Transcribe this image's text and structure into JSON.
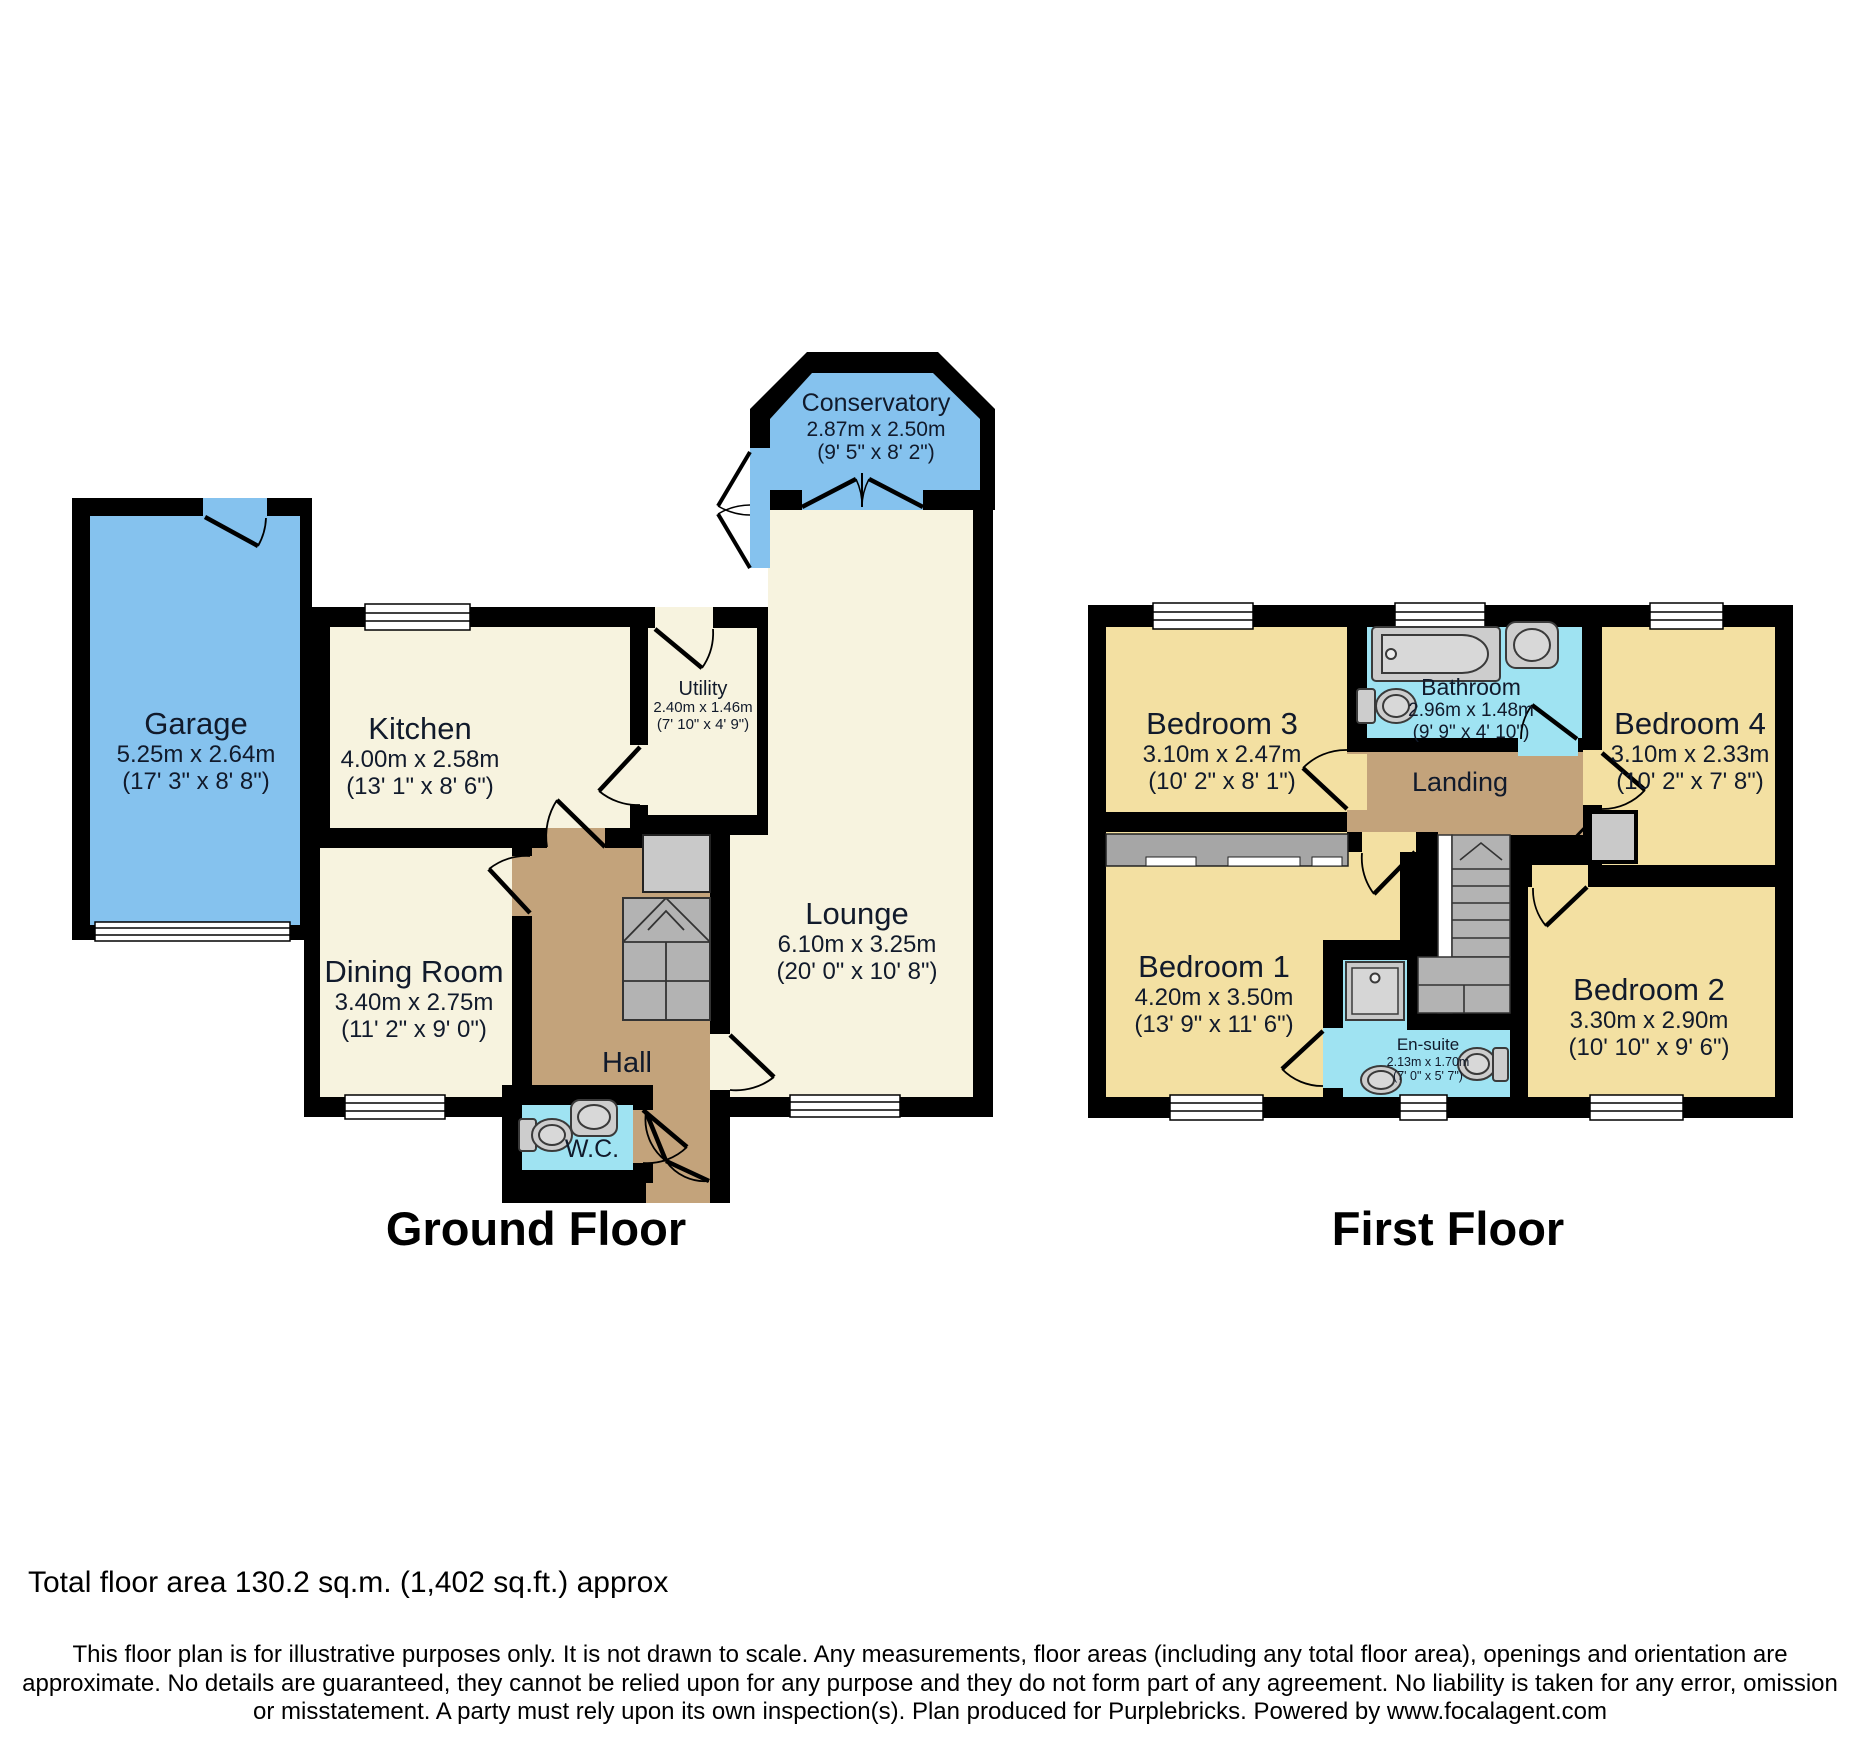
{
  "colors": {
    "wall": "#000000",
    "garage_blue": "#85C2EE",
    "room_cream": "#F7F3DF",
    "bedroom_yellow": "#F3E0A2",
    "wet_cyan": "#9FE3F2",
    "hall_tan": "#C3A37B",
    "stair_gray": "#B3B3B3",
    "cupboard_gray": "#C9C9C9",
    "wardrobe_gray": "#A6A6A6",
    "fixture_gray": "#CDCDCD",
    "fixture_inner_gray": "#D8D8D8",
    "window_white": "#FFFFFF"
  },
  "icons": {
    "bath": "bath-icon",
    "toilet": "toilet-icon",
    "sink": "sink-icon",
    "shower": "shower-icon",
    "stairs": "stairs-icon",
    "window": "window-icon",
    "door": "door-swing-icon",
    "wardrobe": "wardrobe-icon"
  },
  "floors": [
    {
      "label": "Ground Floor",
      "rooms": [
        {
          "name": "Garage",
          "dims_m": "5.25m x 2.64m",
          "dims_ft": "(17' 3\" x 8' 8\")"
        },
        {
          "name": "Kitchen",
          "dims_m": "4.00m x 2.58m",
          "dims_ft": "(13' 1\" x 8' 6\")"
        },
        {
          "name": "Utility",
          "dims_m": "2.40m x 1.46m",
          "dims_ft": "(7' 10\" x 4' 9\")"
        },
        {
          "name": "Conservatory",
          "dims_m": "2.87m x 2.50m",
          "dims_ft": "(9' 5\" x 8' 2\")"
        },
        {
          "name": "Dining Room",
          "dims_m": "3.40m x 2.75m",
          "dims_ft": "(11' 2\" x 9' 0\")"
        },
        {
          "name": "Lounge",
          "dims_m": "6.10m x 3.25m",
          "dims_ft": "(20' 0\" x 10' 8\")"
        },
        {
          "name": "Hall"
        },
        {
          "name": "W.C."
        }
      ]
    },
    {
      "label": "First Floor",
      "rooms": [
        {
          "name": "Bedroom 3",
          "dims_m": "3.10m x 2.47m",
          "dims_ft": "(10' 2\" x 8' 1\")"
        },
        {
          "name": "Bathroom",
          "dims_m": "2.96m x 1.48m",
          "dims_ft": "(9' 9\" x 4' 10\")"
        },
        {
          "name": "Bedroom 4",
          "dims_m": "3.10m x 2.33m",
          "dims_ft": "(10' 2\" x 7' 8\")"
        },
        {
          "name": "Landing"
        },
        {
          "name": "Bedroom 1",
          "dims_m": "4.20m x 3.50m",
          "dims_ft": "(13' 9\" x 11' 6\")"
        },
        {
          "name": "En-suite",
          "dims_m": "2.13m x 1.70m",
          "dims_ft": "(7' 0\" x 5' 7\")"
        },
        {
          "name": "Bedroom 2",
          "dims_m": "3.30m x 2.90m",
          "dims_ft": "(10' 10\" x 9' 6\")"
        }
      ]
    }
  ],
  "footer": {
    "total_area": "Total floor area 130.2 sq.m. (1,402 sq.ft.) approx",
    "disclaimer_lines": [
      "This floor plan is for illustrative purposes only. It is not drawn to scale. Any measurements, floor areas (including any total floor area), openings and orientation are",
      "approximate. No details are guaranteed, they cannot be relied upon for any purpose and they do not form part of any agreement. No liability is taken for any error, omission",
      "or misstatement. A party must rely upon its own inspection(s). Plan produced for Purplebricks. Powered by www.focalagent.com"
    ]
  }
}
